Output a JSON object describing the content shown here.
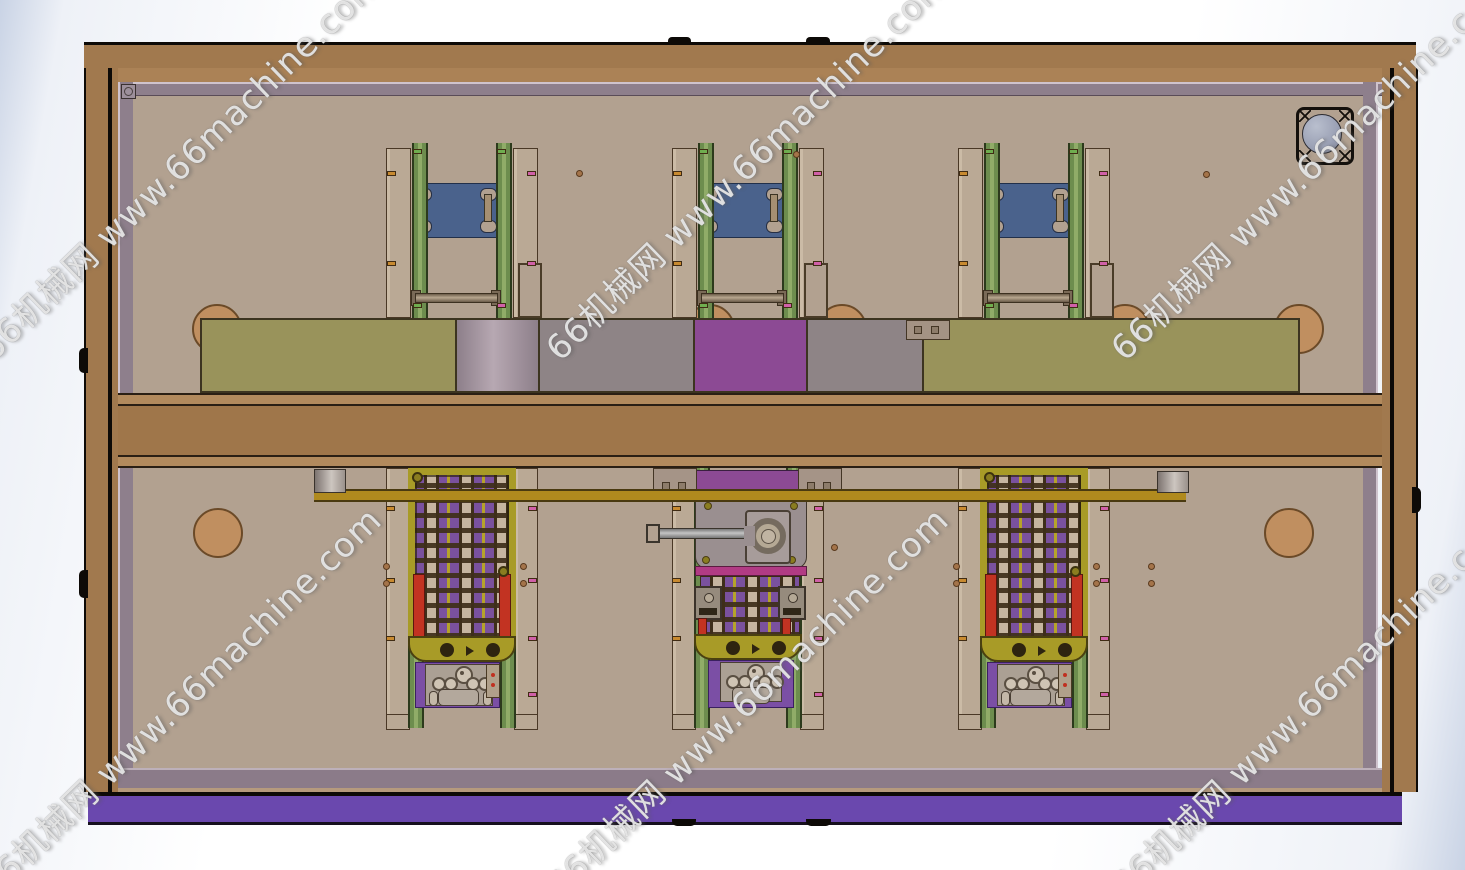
{
  "scene": {
    "description": "CAD top view render of a machine enclosure with three carriage stations",
    "watermark": {
      "text": "66机械网 www.66machine.com",
      "color": "#ffffff",
      "rotation_deg": -44,
      "instances": [
        {
          "cx": 170,
          "cy": 175
        },
        {
          "cx": 737,
          "cy": 175
        },
        {
          "cx": 1302,
          "cy": 175
        },
        {
          "cx": 170,
          "cy": 712
        },
        {
          "cx": 737,
          "cy": 712
        },
        {
          "cx": 1302,
          "cy": 712
        }
      ]
    }
  },
  "layout": {
    "stations": [
      {
        "x": 386,
        "variant": "side"
      },
      {
        "x": 672,
        "variant": "center"
      },
      {
        "x": 958,
        "variant": "side"
      }
    ],
    "humps": [
      192,
      685,
      817,
      1100,
      1274
    ],
    "dots": [
      [
        383,
        563
      ],
      [
        383,
        580
      ],
      [
        520,
        563
      ],
      [
        520,
        580
      ],
      [
        831,
        544
      ],
      [
        953,
        563
      ],
      [
        953,
        580
      ],
      [
        1093,
        563
      ],
      [
        1093,
        580
      ],
      [
        1148,
        563
      ],
      [
        1148,
        580
      ],
      [
        576,
        170
      ],
      [
        793,
        151
      ],
      [
        1203,
        171
      ]
    ]
  },
  "colors": {
    "bg_edge": "#c9d3e5",
    "outline_black": "#0d0a07",
    "frame_brown": "#a1794e",
    "trim_mauve": "#8e7f8c",
    "panel_tan": "#b2a190",
    "khaki": "#99935b",
    "block_purple": "#8c4a94",
    "block_gray": "#8e8486",
    "cyl_light": "#b7a8b2",
    "cyl_dark": "#8d7f8a",
    "beam_brown": "#9f764a",
    "beam_light": "#b28a5d",
    "base_purple": "#6a48ae",
    "base_mauve": "#8b7b89",
    "plate_blue": "#4a628c",
    "rail_green": "#6d8d4e",
    "side_tan": "#baa995",
    "frame_yellow": "#a89b27",
    "bar_red": "#c23322",
    "chain_purple": "#7a519e",
    "chain_tan": "#c6b5a0",
    "chain_dark": "#3e2e1a",
    "bar_magenta": "#b13b84",
    "mech_gray": "#9a8f90",
    "rail_gold": "#b08a1e",
    "cyl_tan": "#c08f60",
    "plate_purple": "#7b4fa5",
    "plate_gray": "#aba094",
    "fan_gray": "#9aa0b4",
    "clip_pink": "#d060a8",
    "clip_green": "#6fae4f",
    "clip_orange": "#c88a30",
    "dot_tan": "#a4744a"
  }
}
